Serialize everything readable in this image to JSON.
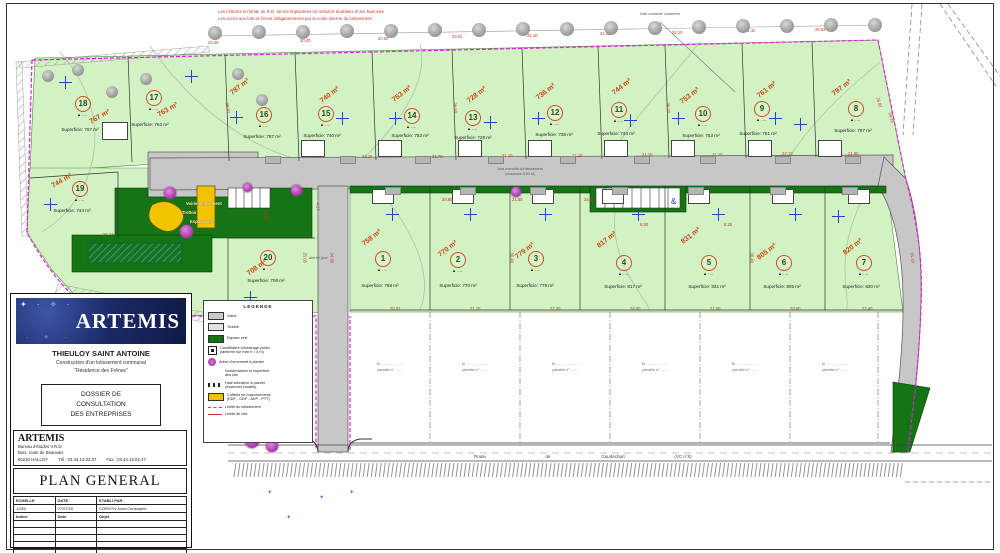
{
  "colors": {
    "site_green": "#d2f2c4",
    "dark_green": "#157515",
    "road_gray": "#c7c7c7",
    "boundary_magenta": "#dd22dd",
    "dim_red": "#c23318",
    "logo_navy": "#1b2a66",
    "yellow": "#f2c400",
    "blue_marker": "#2244cc"
  },
  "title_block": {
    "company_logo": "ARTEMIS",
    "project_title": "THIEULOY SAINT ANTOINE",
    "project_sub1": "Construction d'un lotissement communal",
    "project_sub2": "\"Résidence des Frênes\"",
    "dossier_l1": "DOSSIER DE",
    "dossier_l2": "CONSULTATION",
    "dossier_l3": "DES ENTREPRISES",
    "firm_name": "ARTEMIS",
    "firm_addr1": "Bureau d'études V.R.D.",
    "firm_addr2": "Bois, route de Beauvais",
    "firm_city": "60210  HALLOY",
    "tel": "Tél : 03.44.13.02.37",
    "fax": "Fax : 03.44.13.02.47",
    "doc_title": "PLAN GENERAL",
    "table_h1": "ECHELLE",
    "table_h2": "DATE :",
    "table_h3": "ETABLI PAR :",
    "table_v1": "1/250",
    "table_v2": "07/07/20",
    "table_v3": "CORSYN Jean-Christophe",
    "sub_h1": "Indice",
    "sub_h2": "Date",
    "sub_h3": "Objet"
  },
  "legend": {
    "title": "LEGENDE",
    "items": [
      {
        "type": "swatch",
        "color": "#c7c7c7",
        "label": "Voirie"
      },
      {
        "type": "swatch",
        "color": "#e2e2e2",
        "label": "Trottoir"
      },
      {
        "type": "swatch",
        "color": "#157515",
        "label": "Espace vert"
      },
      {
        "type": "lamp",
        "label": "Candélabre d'éclairage public",
        "label2": "(lanterne sur mât h = 4 m)"
      },
      {
        "type": "tree",
        "label": "Arbre d'ornement à planter"
      },
      {
        "type": "text",
        "label": "Numérotation et superficie",
        "label2": "des lots"
      },
      {
        "type": "ticks",
        "label": "Haie arbustive à planter",
        "label2": "(essences locales)"
      },
      {
        "type": "swatch",
        "color": "#f2c400",
        "label": "Coffrets de branchements",
        "label2": "(EDF - GDF - AEP - PTT)"
      },
      {
        "type": "mline",
        "label": "Limite du lotissement"
      },
      {
        "type": "rline",
        "label": "Limite de lots"
      }
    ]
  },
  "plan": {
    "lot_mark": "▲ ‥‥",
    "lots": [
      {
        "n": "1",
        "area": "758 m²",
        "sup": "Superficie: 758 m²",
        "c": [
          382,
          258
        ],
        "a": [
          372,
          238,
          -38
        ],
        "s": [
          380,
          283
        ],
        "x": [
          392,
          214
        ]
      },
      {
        "n": "2",
        "area": "770 m²",
        "sup": "Superficie: 770 m²",
        "c": [
          457,
          259
        ],
        "a": [
          448,
          249,
          -38
        ],
        "s": [
          458,
          283
        ],
        "x": [
          470,
          214
        ]
      },
      {
        "n": "3",
        "area": "779 m²",
        "sup": "Superficie: 779 m²",
        "c": [
          535,
          258
        ],
        "a": [
          525,
          251,
          -38
        ],
        "s": [
          535,
          283
        ],
        "x": [
          545,
          214
        ]
      },
      {
        "n": "4",
        "area": "817 m²",
        "sup": "Superficie: 817 m²",
        "c": [
          623,
          262
        ],
        "a": [
          607,
          240,
          -38
        ],
        "s": [
          623,
          284
        ],
        "x": [
          638,
          214
        ]
      },
      {
        "n": "5",
        "area": "831 m²",
        "sup": "Superficie: 831 m²",
        "c": [
          708,
          262
        ],
        "a": [
          691,
          236,
          -38
        ],
        "s": [
          707,
          284
        ],
        "x": [
          718,
          214
        ]
      },
      {
        "n": "6",
        "area": "805 m²",
        "sup": "Superficie: 805 m²",
        "c": [
          783,
          262
        ],
        "a": [
          767,
          252,
          -38
        ],
        "s": [
          782,
          284
        ],
        "x": [
          795,
          214
        ]
      },
      {
        "n": "7",
        "area": "820 m²",
        "sup": "Superficie: 820 m²",
        "c": [
          863,
          262
        ],
        "a": [
          853,
          247,
          -38
        ],
        "s": [
          861,
          284
        ],
        "x": [
          838,
          216
        ]
      },
      {
        "n": "8",
        "area": "797 m²",
        "sup": "Superficie: 797 m²",
        "c": [
          855,
          108
        ],
        "a": [
          842,
          88,
          -38
        ],
        "s": [
          853,
          128
        ],
        "x": [
          800,
          124
        ]
      },
      {
        "n": "9",
        "area": "761 m²",
        "sup": "Superficie: 761 m²",
        "c": [
          761,
          108
        ],
        "a": [
          767,
          90,
          -38
        ],
        "s": [
          758,
          131
        ],
        "x": [
          775,
          118
        ]
      },
      {
        "n": "10",
        "area": "753 m²",
        "sup": "Superficie: 753 m²",
        "c": [
          702,
          113
        ],
        "a": [
          690,
          96,
          -38
        ],
        "s": [
          701,
          133
        ],
        "x": [
          678,
          118
        ]
      },
      {
        "n": "11",
        "area": "744 m²",
        "sup": "Superficie: 744 m²",
        "c": [
          618,
          109
        ],
        "a": [
          622,
          87,
          -38
        ],
        "s": [
          616,
          131
        ],
        "x": [
          630,
          120
        ]
      },
      {
        "n": "12",
        "area": "736 m²",
        "sup": "Superficie: 736 m²",
        "c": [
          554,
          112
        ],
        "a": [
          546,
          92,
          -38
        ],
        "s": [
          554,
          132
        ],
        "x": [
          538,
          118
        ]
      },
      {
        "n": "13",
        "area": "728 m²",
        "sup": "Superficie: 728 m²",
        "c": [
          472,
          117
        ],
        "a": [
          477,
          95,
          -38
        ],
        "s": [
          473,
          135
        ],
        "x": [
          490,
          122
        ]
      },
      {
        "n": "14",
        "area": "753 m²",
        "sup": "Superficie: 753 m²",
        "c": [
          411,
          115
        ],
        "a": [
          402,
          94,
          -38
        ],
        "s": [
          410,
          133
        ],
        "x": [
          395,
          118
        ]
      },
      {
        "n": "15",
        "area": "740 m²",
        "sup": "Superficie: 740 m²",
        "c": [
          325,
          113
        ],
        "a": [
          330,
          95,
          -38
        ],
        "s": [
          322,
          133
        ],
        "x": [
          342,
          118
        ]
      },
      {
        "n": "16",
        "area": "787 m²",
        "sup": "Superficie: 787 m²",
        "c": [
          263,
          114
        ],
        "a": [
          240,
          87,
          -38
        ],
        "s": [
          262,
          134
        ],
        "x": [
          236,
          117
        ]
      },
      {
        "n": "17",
        "area": "763 m²",
        "sup": "Superficie: 763 m²",
        "c": [
          153,
          97
        ],
        "a": [
          168,
          110,
          -30
        ],
        "s": [
          150,
          122
        ],
        "x": [
          191,
          76
        ]
      },
      {
        "n": "18",
        "area": "767 m²",
        "sup": "Superficie: 767 m²",
        "c": [
          82,
          103
        ],
        "a": [
          100,
          117,
          -30
        ],
        "s": [
          80,
          127
        ],
        "x": [
          65,
          82
        ]
      },
      {
        "n": "19",
        "area": "744 m²",
        "sup": "Superficie: 744 m²",
        "c": [
          79,
          188
        ],
        "a": [
          62,
          181,
          -30
        ],
        "s": [
          72,
          208
        ],
        "x": [
          50,
          204
        ]
      },
      {
        "n": "20",
        "area": "708 m²",
        "sup": "Superficie: 708 m²",
        "c": [
          267,
          257
        ],
        "a": [
          257,
          268,
          -35
        ],
        "s": [
          266,
          278
        ],
        "x": [
          250,
          297
        ]
      }
    ],
    "dimensions": [
      {
        "t": "24.28",
        "x": 208,
        "y": 40
      },
      {
        "t": "20.00",
        "x": 300,
        "y": 38
      },
      {
        "t": "20.00",
        "x": 378,
        "y": 36
      },
      {
        "t": "20.01",
        "x": 452,
        "y": 34
      },
      {
        "t": "21.10",
        "x": 527,
        "y": 33
      },
      {
        "t": "21.02",
        "x": 600,
        "y": 31
      },
      {
        "t": "21.10",
        "x": 672,
        "y": 30
      },
      {
        "t": "21.10",
        "x": 745,
        "y": 28
      },
      {
        "t": "25.02",
        "x": 815,
        "y": 27
      },
      {
        "t": "25.87",
        "x": 878,
        "y": 95,
        "r": 75
      },
      {
        "t": "22.10",
        "x": 362,
        "y": 154
      },
      {
        "t": "21.70",
        "x": 432,
        "y": 154
      },
      {
        "t": "21.10",
        "x": 502,
        "y": 153
      },
      {
        "t": "21.10",
        "x": 572,
        "y": 153
      },
      {
        "t": "21.10",
        "x": 642,
        "y": 152
      },
      {
        "t": "21.10",
        "x": 712,
        "y": 152
      },
      {
        "t": "22.10",
        "x": 782,
        "y": 151
      },
      {
        "t": "21.80",
        "x": 848,
        "y": 151
      },
      {
        "t": "22.80",
        "x": 372,
        "y": 197
      },
      {
        "t": "20.80",
        "x": 442,
        "y": 197
      },
      {
        "t": "21.80",
        "x": 512,
        "y": 197
      },
      {
        "t": "24.20",
        "x": 584,
        "y": 197
      },
      {
        "t": "6.50",
        "x": 640,
        "y": 222
      },
      {
        "t": "8.20",
        "x": 724,
        "y": 222
      },
      {
        "t": "20.02",
        "x": 390,
        "y": 306
      },
      {
        "t": "21.15",
        "x": 470,
        "y": 306
      },
      {
        "t": "22.30",
        "x": 550,
        "y": 306
      },
      {
        "t": "24.00",
        "x": 630,
        "y": 306
      },
      {
        "t": "21.50",
        "x": 710,
        "y": 306
      },
      {
        "t": "20.80",
        "x": 790,
        "y": 306
      },
      {
        "t": "23.40",
        "x": 862,
        "y": 306
      },
      {
        "t": "28.00",
        "x": 266,
        "y": 208,
        "r": 90
      },
      {
        "t": "25.05",
        "x": 305,
        "y": 250,
        "r": 90
      },
      {
        "t": "26.12",
        "x": 103,
        "y": 232
      },
      {
        "t": "24.28",
        "x": 70,
        "y": 298,
        "r": 40
      },
      {
        "t": "38.10",
        "x": 227,
        "y": 100,
        "r": 80
      },
      {
        "t": "38.50",
        "x": 455,
        "y": 100,
        "r": 87
      },
      {
        "t": "39.20",
        "x": 668,
        "y": 100,
        "r": 87
      },
      {
        "t": "36.40",
        "x": 512,
        "y": 250,
        "r": 90
      },
      {
        "t": "36.40",
        "x": 752,
        "y": 250,
        "r": 90
      },
      {
        "t": "29.18",
        "x": 890,
        "y": 110,
        "r": 75
      },
      {
        "t": "31.10",
        "x": 912,
        "y": 250,
        "r": 83
      },
      {
        "t": "24.35",
        "x": 332,
        "y": 250,
        "r": 90
      },
      {
        "t": "4.17",
        "x": 318,
        "y": 200,
        "r": 90
      }
    ],
    "annotations": {
      "red1": "Les clôtures en limite du R.D. seront implantées en retrait et doublées d'une haie vive",
      "red2": "Les accès aux lots se feront obligatoirement par la voirie interne du lotissement",
      "callout": "Haie existante conservée",
      "center_road1": "Voie nouvelle du lotissement",
      "center_road2": "(chaussée 5.50 m)",
      "entrance": [
        "Voirie lotissement",
        "Trottoir",
        "Espace vert"
      ],
      "aire_de_jeux": "aire de jeux"
    },
    "road_labels": [
      {
        "t": "Route",
        "x": 480
      },
      {
        "t": "de",
        "x": 548
      },
      {
        "t": "Gaudechart",
        "x": 613
      },
      {
        "t": "(VC n°6)",
        "x": 683
      }
    ],
    "parcels": [
      {
        "l1": "M. ………………",
        "l2": "parcelle n° ……"
      },
      {
        "l1": "M. ………………",
        "l2": "parcelle n° ……"
      },
      {
        "l1": "M. ………………",
        "l2": "parcelle n° ……"
      },
      {
        "l1": "M. ………………",
        "l2": "parcelle n° ……"
      },
      {
        "l1": "M. ………………",
        "l2": "parcelle n° ……"
      },
      {
        "l1": "M. ………………",
        "l2": "parcelle n° ……"
      }
    ]
  }
}
